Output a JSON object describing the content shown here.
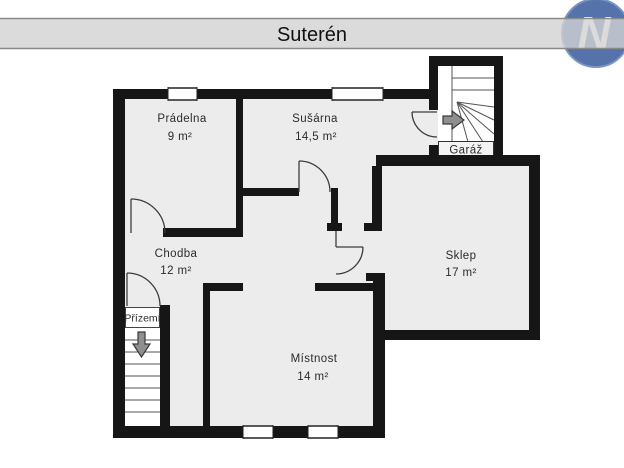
{
  "header": {
    "title": "Suterén",
    "logo_letter": "N"
  },
  "colors": {
    "wall": "#161616",
    "floor": "#ececec",
    "stair_fill": "#ffffff",
    "bar_gray": "#d2d2d2",
    "bar_border": "#8a8a8a",
    "accent_blue": "#5572aa",
    "arrow_gray": "#8f8f8f",
    "line_dark": "#3c3c3c",
    "label_text": "#2b2b2b"
  },
  "rooms": {
    "pradelna": {
      "name": "Prádelna",
      "area": "9 m²"
    },
    "susarna": {
      "name": "Sušárna",
      "area": "14,5 m²"
    },
    "garaz": {
      "name": "Garáž"
    },
    "chodba": {
      "name": "Chodba",
      "area": "12 m²"
    },
    "sklep": {
      "name": "Sklep",
      "area": "17 m²"
    },
    "prizemi": {
      "name": "Přízemí"
    },
    "mistnost": {
      "name": "Místnost",
      "area": "14 m²"
    }
  }
}
